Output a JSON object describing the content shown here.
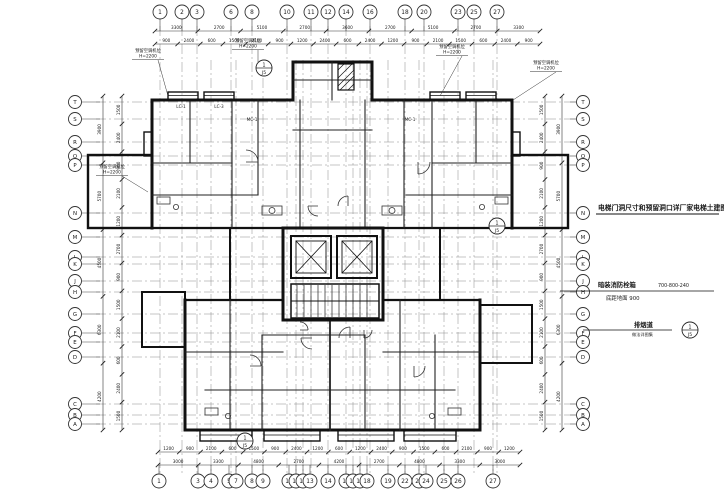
{
  "drawing_type": "residential-tower-floor-plan",
  "colors": {
    "line": "#111111",
    "grid": "#8a8a8a",
    "dim": "#333333",
    "paper": "#ffffff"
  },
  "grid": {
    "top": [
      {
        "x": 160,
        "label": "1"
      },
      {
        "x": 182,
        "label": "2"
      },
      {
        "x": 197,
        "label": "3"
      },
      {
        "x": 231,
        "label": "6"
      },
      {
        "x": 252,
        "label": "8"
      },
      {
        "x": 287,
        "label": "10"
      },
      {
        "x": 311,
        "label": "11"
      },
      {
        "x": 328,
        "label": "12"
      },
      {
        "x": 346,
        "label": "14"
      },
      {
        "x": 370,
        "label": "16"
      },
      {
        "x": 405,
        "label": "18"
      },
      {
        "x": 424,
        "label": "20"
      },
      {
        "x": 458,
        "label": "23"
      },
      {
        "x": 474,
        "label": "25"
      },
      {
        "x": 497,
        "label": "27"
      }
    ],
    "bottom": [
      {
        "x": 159,
        "label": "1"
      },
      {
        "x": 198,
        "label": "3"
      },
      {
        "x": 211,
        "label": "4"
      },
      {
        "x": 229,
        "label": "5"
      },
      {
        "x": 236,
        "label": "7"
      },
      {
        "x": 252,
        "label": "8"
      },
      {
        "x": 263,
        "label": "9"
      },
      {
        "x": 289,
        "label": "10"
      },
      {
        "x": 296,
        "label": "11"
      },
      {
        "x": 303,
        "label": "12"
      },
      {
        "x": 310,
        "label": "13"
      },
      {
        "x": 328,
        "label": "14"
      },
      {
        "x": 346,
        "label": "15"
      },
      {
        "x": 353,
        "label": "16"
      },
      {
        "x": 360,
        "label": "17"
      },
      {
        "x": 367,
        "label": "18"
      },
      {
        "x": 388,
        "label": "19"
      },
      {
        "x": 405,
        "label": "22"
      },
      {
        "x": 419,
        "label": "23"
      },
      {
        "x": 426,
        "label": "24"
      },
      {
        "x": 444,
        "label": "25"
      },
      {
        "x": 458,
        "label": "26"
      },
      {
        "x": 493,
        "label": "27"
      }
    ],
    "left": [
      {
        "y": 102,
        "label": "T"
      },
      {
        "y": 119,
        "label": "S"
      },
      {
        "y": 142,
        "label": "R"
      },
      {
        "y": 156,
        "label": "Q"
      },
      {
        "y": 165,
        "label": "P"
      },
      {
        "y": 213,
        "label": "N"
      },
      {
        "y": 237,
        "label": "M"
      },
      {
        "y": 257,
        "label": "L"
      },
      {
        "y": 264,
        "label": "K"
      },
      {
        "y": 281,
        "label": "J"
      },
      {
        "y": 292,
        "label": "H"
      },
      {
        "y": 314,
        "label": "G"
      },
      {
        "y": 333,
        "label": "F"
      },
      {
        "y": 342,
        "label": "E"
      },
      {
        "y": 357,
        "label": "D"
      },
      {
        "y": 404,
        "label": "C"
      },
      {
        "y": 415,
        "label": "B"
      },
      {
        "y": 424,
        "label": "A"
      }
    ],
    "right": [
      {
        "y": 102,
        "label": "T"
      },
      {
        "y": 119,
        "label": "S"
      },
      {
        "y": 142,
        "label": "R"
      },
      {
        "y": 156,
        "label": "Q"
      },
      {
        "y": 165,
        "label": "P"
      },
      {
        "y": 213,
        "label": "N"
      },
      {
        "y": 237,
        "label": "M"
      },
      {
        "y": 257,
        "label": "L"
      },
      {
        "y": 264,
        "label": "K"
      },
      {
        "y": 281,
        "label": "J"
      },
      {
        "y": 292,
        "label": "H"
      },
      {
        "y": 314,
        "label": "G"
      },
      {
        "y": 333,
        "label": "F"
      },
      {
        "y": 342,
        "label": "E"
      },
      {
        "y": 357,
        "label": "D"
      },
      {
        "y": 404,
        "label": "C"
      },
      {
        "y": 415,
        "label": "B"
      },
      {
        "y": 424,
        "label": "A"
      }
    ]
  },
  "dimensions": {
    "top_row1": [
      "3300",
      "2700",
      "5100",
      "2700",
      "3600",
      "2700",
      "5100",
      "2700",
      "3300"
    ],
    "top_row2": [
      "900",
      "2400",
      "600",
      "1500",
      "2100",
      "900",
      "1200",
      "2400",
      "600",
      "2400",
      "1200",
      "900",
      "2100",
      "1500",
      "600",
      "2400",
      "900"
    ],
    "bottom_row1": [
      "1200",
      "900",
      "2100",
      "600",
      "1500",
      "900",
      "2400",
      "1200",
      "600",
      "1200",
      "2400",
      "900",
      "1500",
      "600",
      "2100",
      "900",
      "1200"
    ],
    "bottom_row2": [
      "3000",
      "3300",
      "4800",
      "2700",
      "4200",
      "2700",
      "4800",
      "3300",
      "3000"
    ],
    "left_col_inner": [
      "1500",
      "2400",
      "900",
      "2100",
      "1200",
      "2700",
      "900",
      "1500",
      "2100",
      "600",
      "2400",
      "1500"
    ],
    "left_col_outer": [
      "3900",
      "5700",
      "4500",
      "6300",
      "4200"
    ],
    "right_col_inner": [
      "1500",
      "2400",
      "900",
      "2100",
      "1200",
      "2700",
      "900",
      "1500",
      "2100",
      "600",
      "2400",
      "1500"
    ],
    "right_col_outer": [
      "3900",
      "5700",
      "4500",
      "6300",
      "4200"
    ]
  },
  "annotations": {
    "elevator_note": "电梯门洞尺寸和预留洞口详厂家电梯土建图",
    "hydrant_label": "暗装消防栓箱",
    "hydrant_size": "700-800-240",
    "hydrant_sub": "底距地面 900",
    "flue_label": "排烟道",
    "flue_sub": "做法详图集",
    "ac_unit_label": "预留空调机位",
    "ac_unit_height": "H=2200",
    "detail_ref_top": "1",
    "detail_ref_bottom": "J5"
  },
  "plan_labels": {
    "door_tag": "MC-1",
    "window_tag_1": "LC-1",
    "window_tag_2": "LC-3"
  }
}
